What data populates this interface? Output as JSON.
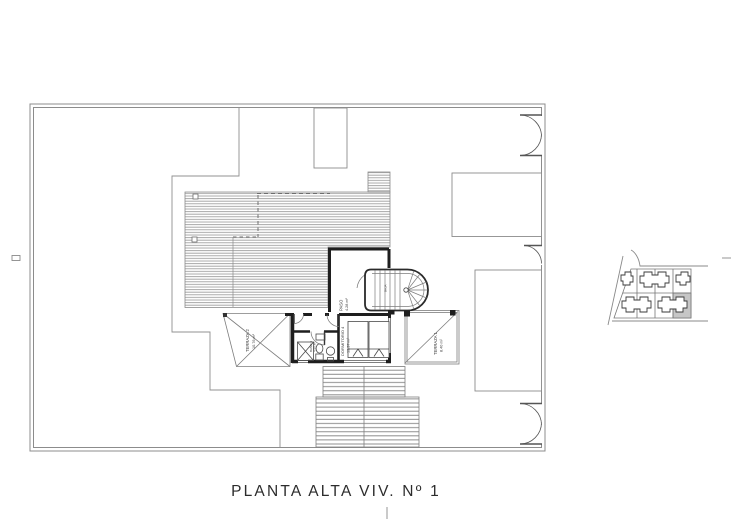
{
  "drawing": {
    "title": "PLANTA ALTA VIV. Nº 1",
    "rooms": {
      "paso": {
        "name": "PASO",
        "area": "4.28 m²"
      },
      "dormitorio4": {
        "name": "DORMITORIO 4",
        "area": "13.37 m²"
      },
      "bano3": {
        "name": "BAÑO 3",
        "area": "4.50 m²"
      },
      "terraza1": {
        "name": "TERRAZA 1",
        "area": "8.40 m²"
      },
      "terraza2": {
        "name": "TERRAZA 2",
        "area": "10.76 m²"
      },
      "stair_note": "BAJA"
    },
    "colors": {
      "line": "#7d7d7d",
      "wall": "#1e1e1e",
      "roof_hatch": "#a0a0a0",
      "selected_plot": "#c6c6c6",
      "text": "#2c2c2c",
      "background": "#ffffff"
    }
  }
}
